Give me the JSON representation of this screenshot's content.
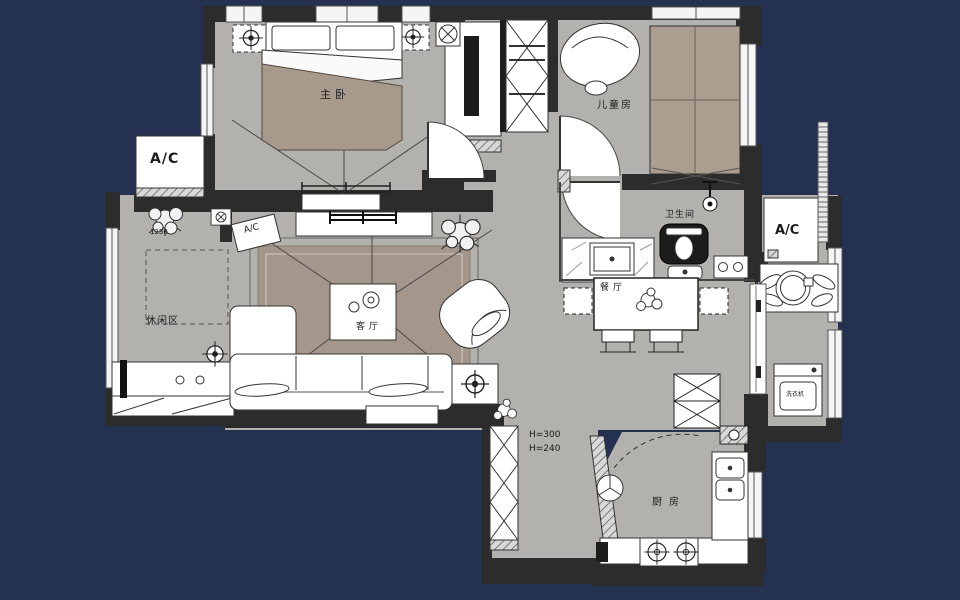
{
  "app": {
    "type": "apartment-floor-plan-cad-drawing",
    "background_color": "#253150"
  },
  "palette": {
    "canvas_background": "#253150",
    "floor_gray": "#b3b1ad",
    "wall_dark": "#2c2c2c",
    "rug_brown": "#a4968a",
    "bed_blanket_tan": "#a79a8c",
    "kids_bed_tan": "#ab9d90",
    "furniture_white": "#ffffff",
    "line_dark": "#333333"
  },
  "rooms": {
    "master_bedroom": {
      "label": "主卧"
    },
    "kids_room": {
      "label": "儿童房"
    },
    "bathroom": {
      "label": "卫生间"
    },
    "living_room": {
      "label": "客厅"
    },
    "dining_room": {
      "label": "餐厅"
    },
    "leisure_area": {
      "label": "休闲区"
    },
    "kitchen": {
      "label": "厨房"
    }
  },
  "annotations": {
    "ac_unit_left": {
      "label": "A/C"
    },
    "ac_unit_living": {
      "label": "A/C"
    },
    "ac_unit_right": {
      "label": "A/C"
    },
    "height_notes": [
      "H=300",
      "H=240"
    ],
    "dimension_label": "1250",
    "washer_label": "洗衣机"
  },
  "icons": [
    "ceiling-lamp-target-icon",
    "gas-burner-icon",
    "exhaust-fan-icon",
    "vent-icon",
    "plant-icon",
    "flower-icon",
    "shower-head-icon"
  ]
}
